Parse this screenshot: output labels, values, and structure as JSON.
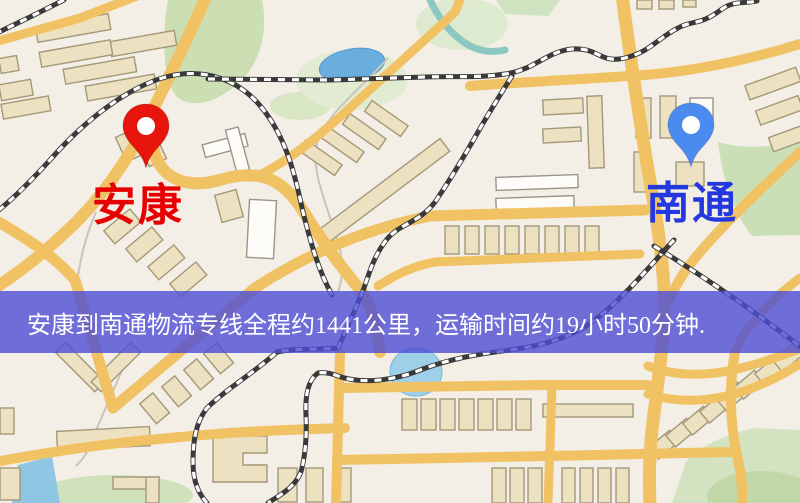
{
  "map": {
    "origin": {
      "label": "安康",
      "pin_color": "#e8150d",
      "pin_edge_color": "#c21208",
      "label_color": "#e60000"
    },
    "destination": {
      "label": "南通",
      "pin_color": "#4b8bf0",
      "pin_edge_color": "#3a78d8",
      "label_color": "#2438e0"
    },
    "banner": {
      "text": "安康到南通物流专线全程约1441公里，运输时间约19小时50分钟.",
      "bg_color": "#4d4dd6",
      "text_color": "#ffffff"
    },
    "legend_colors": {
      "background": "#f3eee6",
      "road": "#f1c263",
      "park": "#cddfb4",
      "water": "#6aaede",
      "building": "#ece2c1",
      "railway": "#3a3a3a"
    }
  }
}
